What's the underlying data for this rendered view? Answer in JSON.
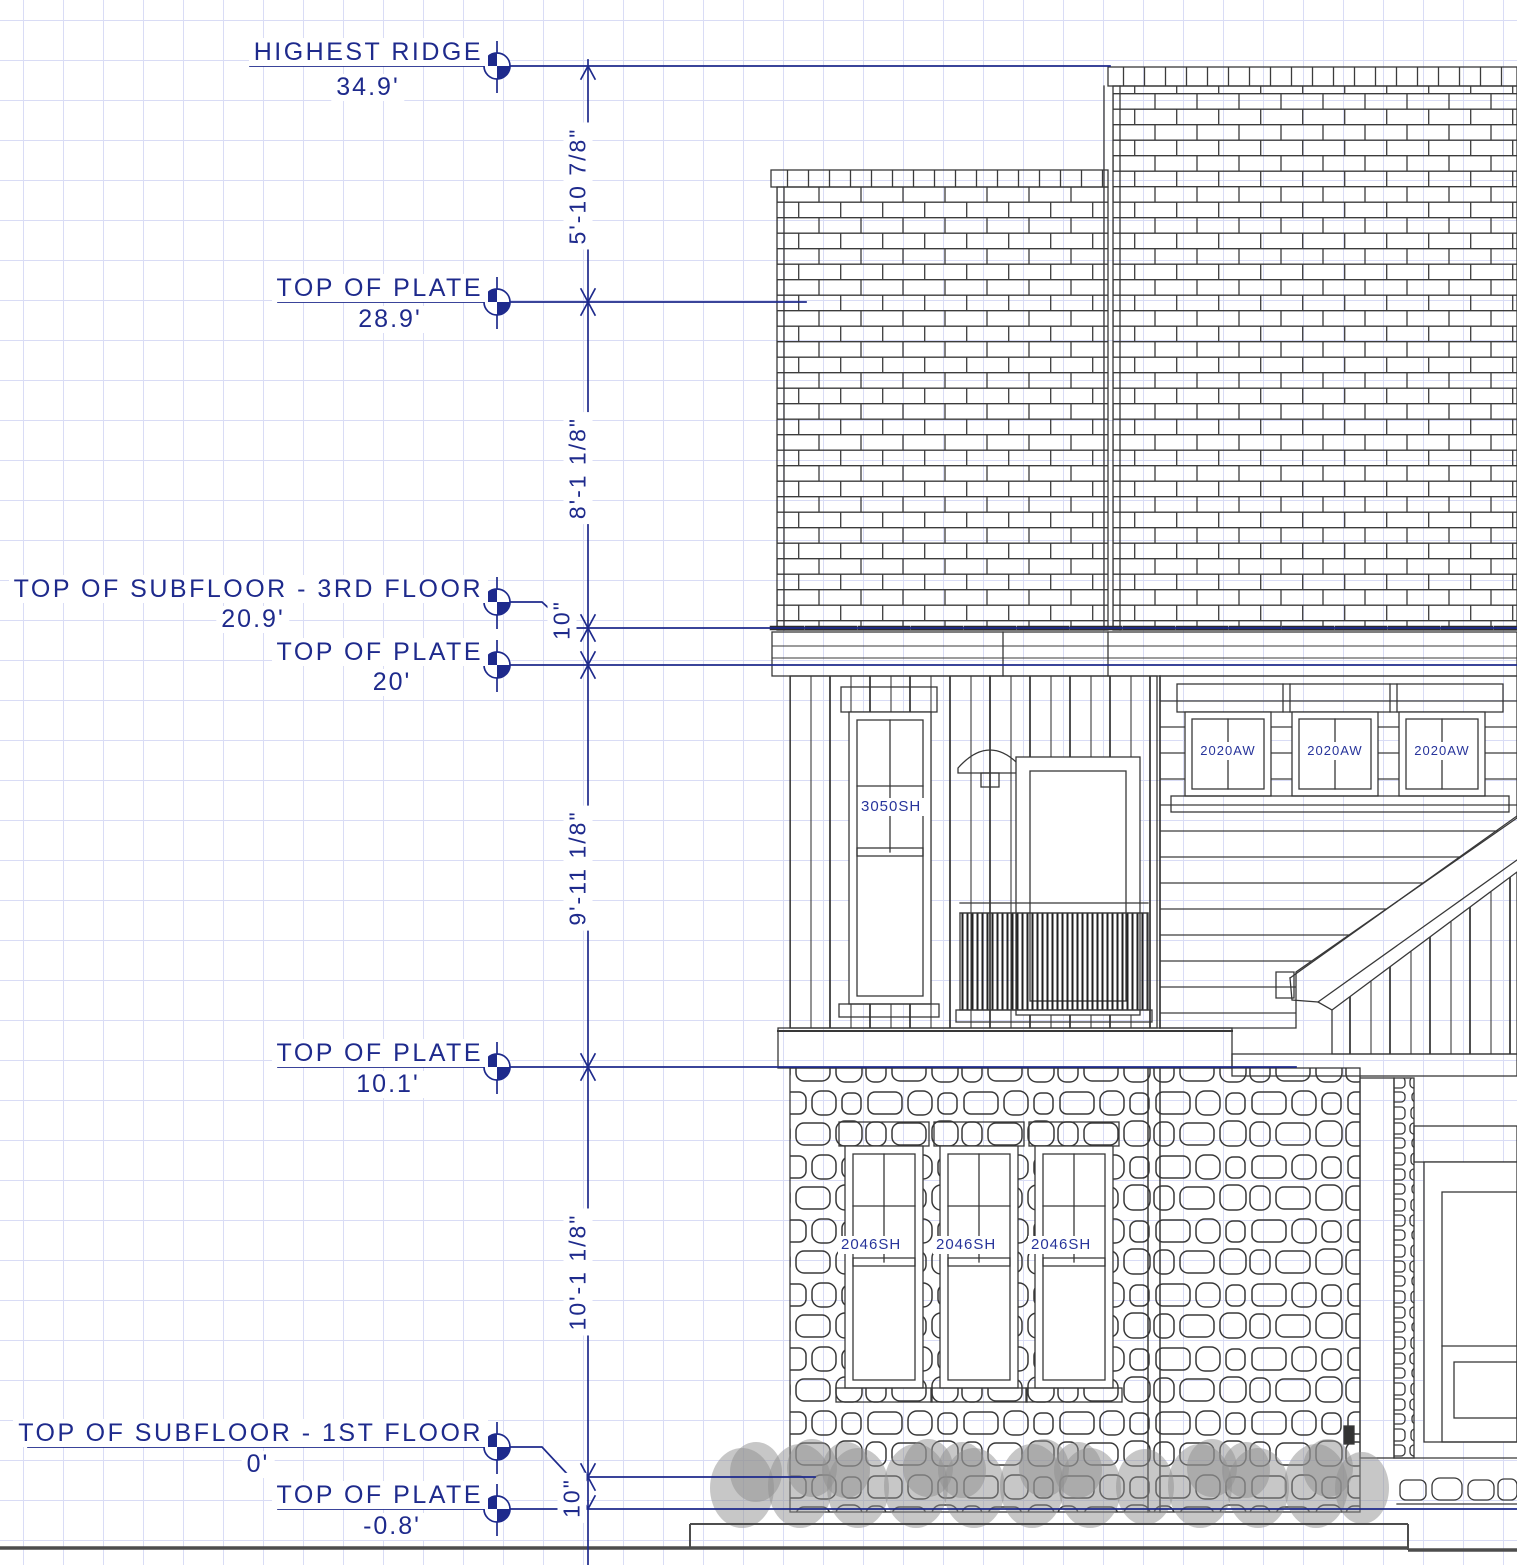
{
  "drawing": {
    "view_name": "exterior-elevation",
    "colors": {
      "annotation": "#1e2a8c",
      "linework": "#383838",
      "grid": "#d9dcf5"
    },
    "levels": [
      {
        "name": "highest-ridge",
        "label": "HIGHEST RIDGE",
        "elevation": "34.9'"
      },
      {
        "name": "top-of-plate-roof",
        "label": "TOP OF PLATE",
        "elevation": "28.9'"
      },
      {
        "name": "top-of-subfloor-3rd-floor",
        "label": "TOP OF SUBFLOOR - 3RD FLOOR",
        "elevation": "20.9'"
      },
      {
        "name": "top-of-plate-2nd",
        "label": "TOP OF PLATE",
        "elevation": "20'"
      },
      {
        "name": "top-of-plate-1st",
        "label": "TOP OF PLATE",
        "elevation": "10.1'"
      },
      {
        "name": "top-of-subfloor-1st-floor",
        "label": "TOP OF SUBFLOOR - 1ST FLOOR",
        "elevation": "0'"
      },
      {
        "name": "top-of-plate-basement",
        "label": "TOP OF PLATE",
        "elevation": "-0.8'"
      }
    ],
    "dimensions": [
      "5'-10 7/8\"",
      "8'-1 1/8\"",
      "10\"",
      "9'-11 1/8\"",
      "10'-1 1/8\"",
      "10\""
    ],
    "window_labels": {
      "second_floor_single_hung": "3050SH",
      "second_floor_awning": [
        "2020AW",
        "2020AW",
        "2020AW"
      ],
      "first_floor_single_hung": [
        "2046SH",
        "2046SH",
        "2046SH"
      ]
    }
  }
}
